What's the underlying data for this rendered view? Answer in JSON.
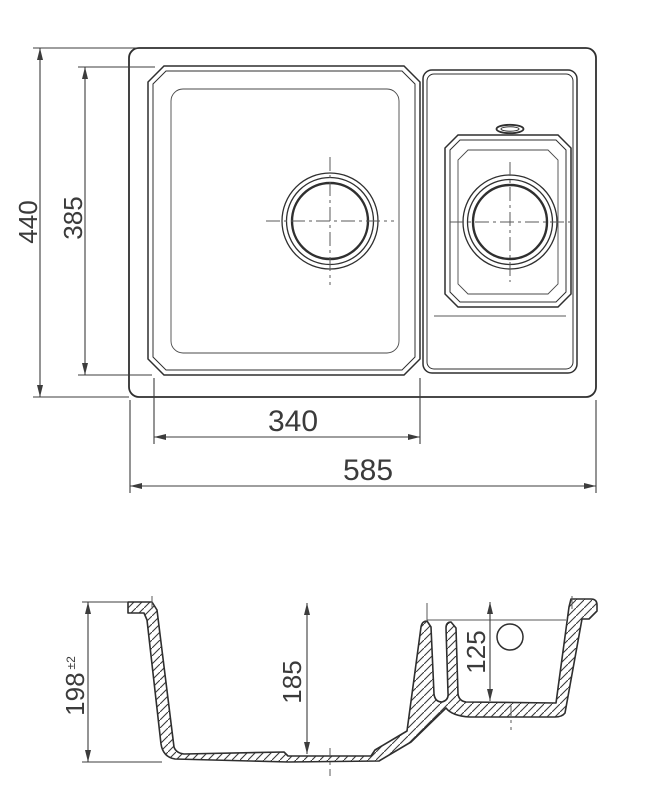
{
  "drawing": {
    "type": "technical-drawing",
    "subject": "1.5 bowl kitchen sink with plan view and cross-section",
    "colors": {
      "line": "#2f2f2f",
      "thin_line": "#5a5a5a",
      "dim": "#3c3c3c"
    },
    "views": {
      "plan": {
        "dims": {
          "overall_height": {
            "value": "440"
          },
          "bowl_height": {
            "value": "385"
          },
          "bowl_width": {
            "value": "340"
          },
          "overall_width": {
            "value": "585"
          }
        }
      },
      "section": {
        "dims": {
          "overall_depth": {
            "value": "198",
            "tolerance": "±2"
          },
          "main_bowl_depth": {
            "value": "185"
          },
          "small_bowl_depth": {
            "value": "125"
          }
        }
      }
    }
  }
}
